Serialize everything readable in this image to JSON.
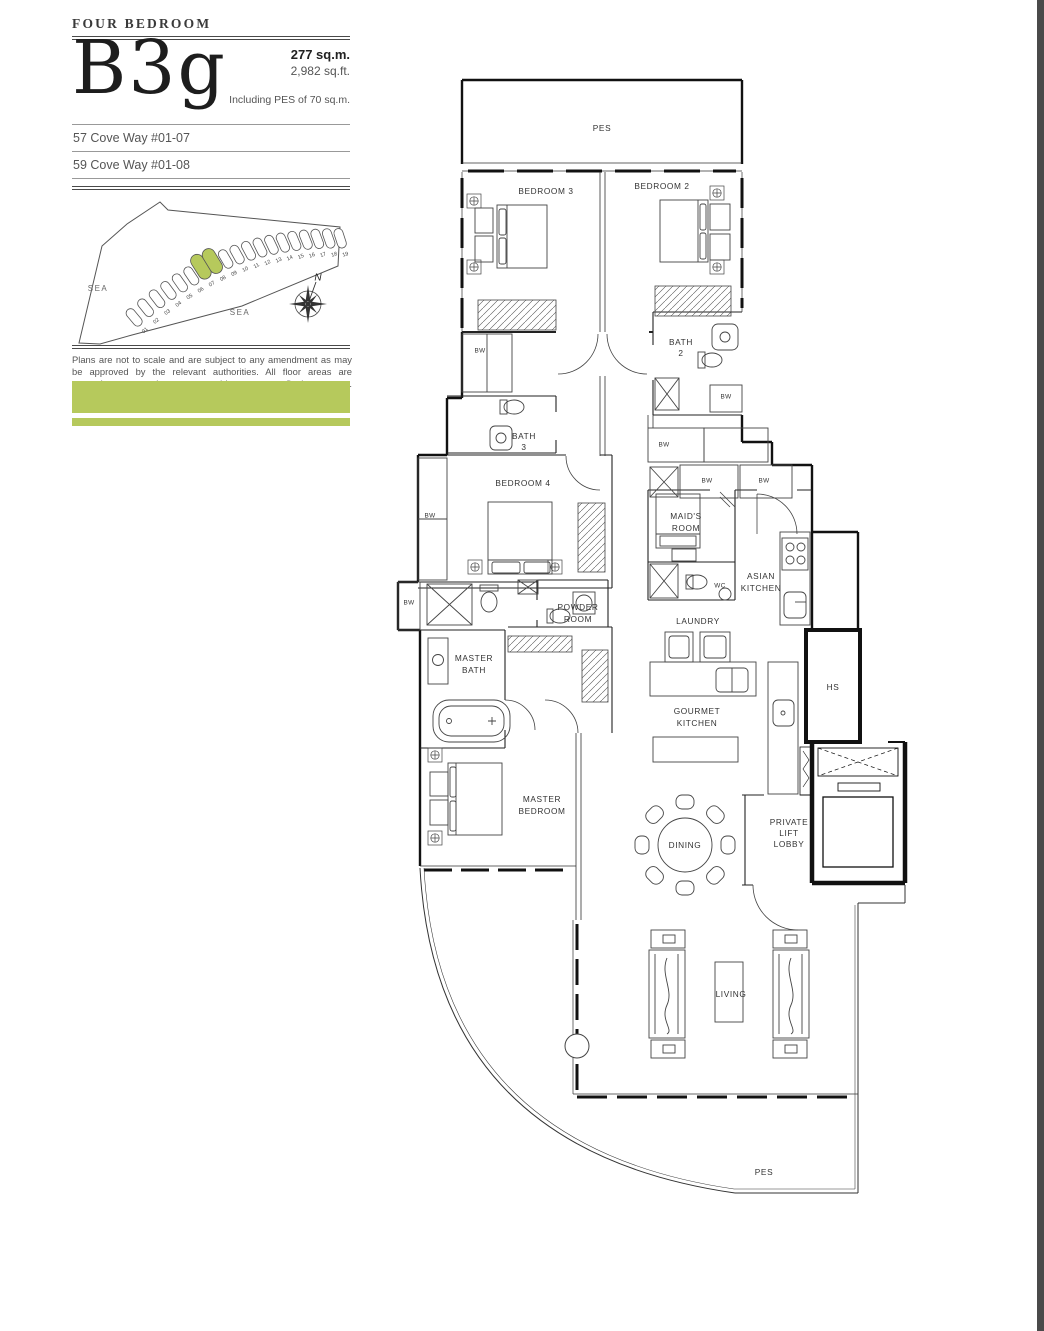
{
  "header": {
    "category": "FOUR BEDROOM",
    "unit_code": "B3g",
    "area_sqm": "277 sq.m.",
    "area_sqft": "2,982 sq.ft.",
    "pes_note": "Including PES of 70 sq.m.",
    "addresses": [
      "57 Cove Way #01-07",
      "59 Cove Way #01-08"
    ]
  },
  "site_map": {
    "lots": [
      "01",
      "02",
      "03",
      "04",
      "05",
      "06",
      "07",
      "08",
      "09",
      "10",
      "11",
      "12",
      "13",
      "14",
      "15",
      "16",
      "17",
      "18",
      "19"
    ],
    "highlighted": [
      "07",
      "08"
    ],
    "sea_label": "SEA",
    "north_label": "N"
  },
  "disclaimer": "Plans are not to scale and are subject to any amendment as may be approved by the relevant authorities. All floor areas are approximate and are subject to final survey.",
  "accent": {
    "green": "#b6c95c",
    "edge_strip": "#4a4a4a"
  },
  "plan": {
    "labels": {
      "pes_top": "PES",
      "bedroom3": "BEDROOM 3",
      "bedroom2": "BEDROOM 2",
      "bath2": [
        "BATH",
        "2"
      ],
      "bath3": [
        "BATH",
        "3"
      ],
      "bedroom4": "BEDROOM 4",
      "bw": "BW",
      "maids_room": [
        "MAID'S",
        "ROOM"
      ],
      "wc": "WC",
      "asian_kitchen": [
        "ASIAN",
        "KITCHEN"
      ],
      "laundry": "LAUNDRY",
      "powder_room": [
        "POWDER",
        "ROOM"
      ],
      "master_bath": [
        "MASTER",
        "BATH"
      ],
      "hs": "HS",
      "gourmet_kitchen": [
        "GOURMET",
        "KITCHEN"
      ],
      "master_bedroom": [
        "MASTER",
        "BEDROOM"
      ],
      "dining": "DINING",
      "private_lift_lobby": [
        "PRIVATE",
        "LIFT",
        "LOBBY"
      ],
      "living": "LIVING",
      "pes_bottom": "PES"
    }
  }
}
